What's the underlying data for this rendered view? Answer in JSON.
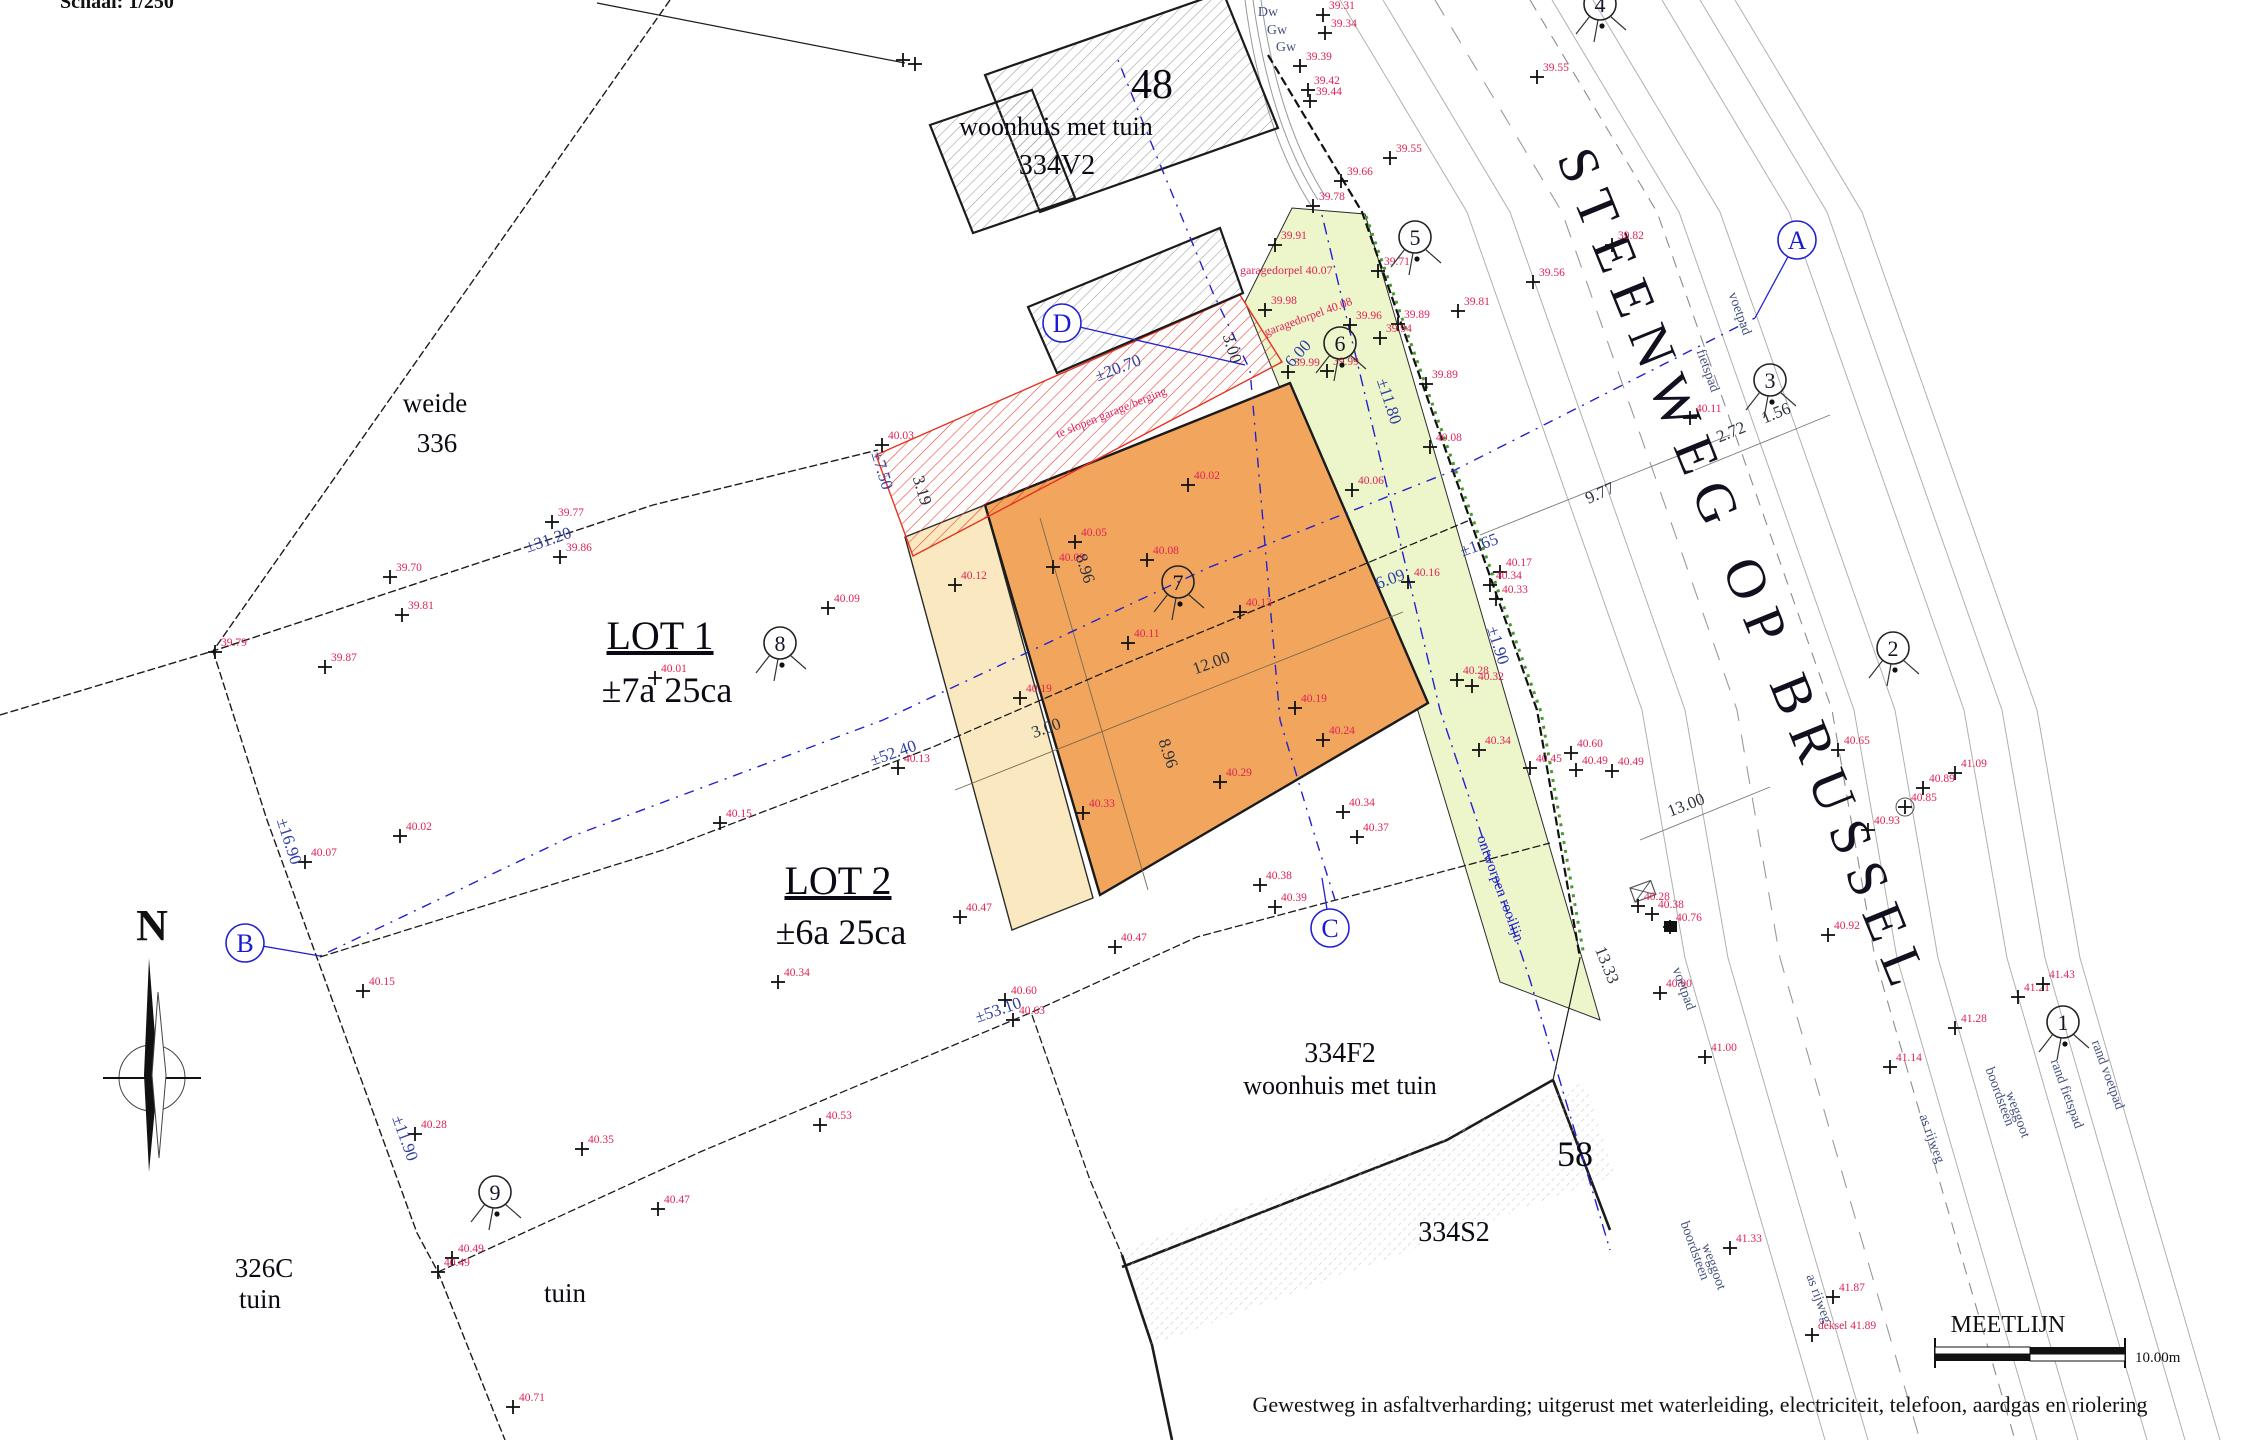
{
  "meta": {
    "scale_note": "Schaal: 1/250",
    "road_name": "STEENWEG OP BRUSSEL",
    "rooilijn_label": "ontworpen rooilijn",
    "meetlijn_title": "MEETLIJN",
    "meetlijn_scale": "10.00m",
    "bottom_note": "Gewestweg in asfaltverharding; uitgerust met waterleiding, electriciteit, telefoon, aardgas en riolering"
  },
  "colors": {
    "lot_orange": "#F2A55C",
    "lot_cream": "#FAE9C0",
    "verge_green": "#EDF5CB",
    "demolish_red": "#E63322",
    "meetlijn_blue": "#2222D0",
    "elevation_red": "#E02355",
    "dimension_blue": "#2F3F9F",
    "hedge_green": "#4A9A30"
  },
  "parcel_labels": [
    {
      "t": "weide",
      "x": 435,
      "y": 412,
      "fs": 27
    },
    {
      "t": "336",
      "x": 437,
      "y": 452,
      "fs": 27
    },
    {
      "t": "LOT 1",
      "x": 660,
      "y": 649,
      "fs": 40,
      "u": 1
    },
    {
      "t": "±7a 25ca",
      "x": 667,
      "y": 702,
      "fs": 36
    },
    {
      "t": "LOT 2",
      "x": 838,
      "y": 894,
      "fs": 40,
      "u": 1
    },
    {
      "t": "±6a 25ca",
      "x": 841,
      "y": 944,
      "fs": 36
    },
    {
      "t": "326C",
      "x": 264,
      "y": 1277,
      "fs": 27
    },
    {
      "t": "tuin",
      "x": 260,
      "y": 1308,
      "fs": 27
    },
    {
      "t": "tuin",
      "x": 565,
      "y": 1302,
      "fs": 27
    },
    {
      "t": "48",
      "x": 1152,
      "y": 98,
      "fs": 42
    },
    {
      "t": "woonhuis met tuin",
      "x": 1056,
      "y": 135,
      "fs": 26
    },
    {
      "t": "334V2",
      "x": 1057,
      "y": 174,
      "fs": 28
    },
    {
      "t": "334F2",
      "x": 1340,
      "y": 1062,
      "fs": 28
    },
    {
      "t": "woonhuis met tuin",
      "x": 1340,
      "y": 1094,
      "fs": 26
    },
    {
      "t": "334S2",
      "x": 1454,
      "y": 1241,
      "fs": 28
    },
    {
      "t": "58",
      "x": 1575,
      "y": 1166,
      "fs": 36
    }
  ],
  "red_notes": [
    {
      "t": "garagedorpel 40.07",
      "x": 1240,
      "y": 274,
      "r": 0
    },
    {
      "t": "garagedorpel 40.08",
      "x": 1266,
      "y": 336,
      "r": -20
    },
    {
      "t": "te slopen garage/berging",
      "x": 1058,
      "y": 438,
      "r": -22
    }
  ],
  "dimensions": [
    {
      "t": "±20.70",
      "x": 1120,
      "y": 373,
      "r": -21
    },
    {
      "t": "±7.50",
      "x": 877,
      "y": 472,
      "r": 73
    },
    {
      "t": "3.19",
      "x": 917,
      "y": 492,
      "r": 73,
      "dark": 1
    },
    {
      "t": "3.00",
      "x": 1227,
      "y": 350,
      "r": 73,
      "dark": 1
    },
    {
      "t": "6.00",
      "x": 1302,
      "y": 357,
      "r": -48
    },
    {
      "t": "±31.20",
      "x": 550,
      "y": 545,
      "r": -19
    },
    {
      "t": "±52.40",
      "x": 895,
      "y": 758,
      "r": -19
    },
    {
      "t": "±53.10",
      "x": 1000,
      "y": 1015,
      "r": -19
    },
    {
      "t": "±16.90",
      "x": 284,
      "y": 843,
      "r": 72
    },
    {
      "t": "±11.90",
      "x": 400,
      "y": 1140,
      "r": 70
    },
    {
      "t": "±11.80",
      "x": 1384,
      "y": 403,
      "r": 72
    },
    {
      "t": "±1.65",
      "x": 1481,
      "y": 550,
      "r": -20
    },
    {
      "t": "6.09",
      "x": 1392,
      "y": 584,
      "r": -20
    },
    {
      "t": "±1.90",
      "x": 1493,
      "y": 647,
      "r": 72
    },
    {
      "t": "9.77",
      "x": 1602,
      "y": 498,
      "r": -24,
      "dark": 1
    },
    {
      "t": "2.72",
      "x": 1733,
      "y": 437,
      "r": -22,
      "dark": 1
    },
    {
      "t": "1.56",
      "x": 1778,
      "y": 418,
      "r": -22,
      "dark": 1
    },
    {
      "t": "13.00",
      "x": 1688,
      "y": 810,
      "r": -21,
      "dark": 1
    },
    {
      "t": "13.33",
      "x": 1602,
      "y": 967,
      "r": 68,
      "dark": 1
    },
    {
      "t": "8.96",
      "x": 1080,
      "y": 570,
      "r": 72,
      "dark": 1
    },
    {
      "t": "8.96",
      "x": 1163,
      "y": 755,
      "r": 72,
      "dark": 1
    },
    {
      "t": "12.00",
      "x": 1213,
      "y": 668,
      "r": -20,
      "dark": 1
    },
    {
      "t": "3.00",
      "x": 1048,
      "y": 733,
      "r": -20,
      "dark": 1
    }
  ],
  "survey_points": [
    {
      "v": "39.31",
      "x": 1323,
      "y": 15
    },
    {
      "v": "39.34",
      "x": 1325,
      "y": 33
    },
    {
      "v": "39.39",
      "x": 1300,
      "y": 66
    },
    {
      "v": "39.42",
      "x": 1308,
      "y": 90
    },
    {
      "v": "39.44",
      "x": 1310,
      "y": 101
    },
    {
      "v": "39.55",
      "x": 1537,
      "y": 77
    },
    {
      "v": "39.55",
      "x": 1390,
      "y": 158
    },
    {
      "v": "39.66",
      "x": 1341,
      "y": 181
    },
    {
      "v": "39.78",
      "x": 1313,
      "y": 206
    },
    {
      "v": "39.91",
      "x": 1275,
      "y": 245
    },
    {
      "v": "39.71",
      "x": 1378,
      "y": 271
    },
    {
      "v": "39.82",
      "x": 1612,
      "y": 245
    },
    {
      "v": "39.56",
      "x": 1533,
      "y": 282
    },
    {
      "v": "39.81",
      "x": 1458,
      "y": 311
    },
    {
      "v": "39.96",
      "x": 1350,
      "y": 325
    },
    {
      "v": "39.89",
      "x": 1398,
      "y": 324
    },
    {
      "v": "39.94",
      "x": 1380,
      "y": 338
    },
    {
      "v": "39.89",
      "x": 1426,
      "y": 384
    },
    {
      "v": "39.98",
      "x": 1265,
      "y": 310
    },
    {
      "v": "39.99",
      "x": 1288,
      "y": 372
    },
    {
      "v": "39.99",
      "x": 1327,
      "y": 371
    },
    {
      "v": "40.03",
      "x": 882,
      "y": 445
    },
    {
      "v": "40.02",
      "x": 1188,
      "y": 485
    },
    {
      "v": "40.06",
      "x": 1352,
      "y": 490
    },
    {
      "v": "40.05",
      "x": 1075,
      "y": 542
    },
    {
      "v": "40.08",
      "x": 1147,
      "y": 560
    },
    {
      "v": "40.09",
      "x": 1053,
      "y": 567
    },
    {
      "v": "40.12",
      "x": 955,
      "y": 585
    },
    {
      "v": "40.11",
      "x": 1128,
      "y": 643
    },
    {
      "v": "40.13",
      "x": 1240,
      "y": 612
    },
    {
      "v": "40.08",
      "x": 1430,
      "y": 447
    },
    {
      "v": "40.11",
      "x": 1690,
      "y": 418
    },
    {
      "v": "40.19",
      "x": 1020,
      "y": 698
    },
    {
      "v": "40.19",
      "x": 1295,
      "y": 708
    },
    {
      "v": "40.24",
      "x": 1323,
      "y": 740
    },
    {
      "v": "40.29",
      "x": 1220,
      "y": 782
    },
    {
      "v": "40.33",
      "x": 1083,
      "y": 813
    },
    {
      "v": "40.34",
      "x": 1343,
      "y": 812
    },
    {
      "v": "40.16",
      "x": 1408,
      "y": 582
    },
    {
      "v": "40.17",
      "x": 1500,
      "y": 572
    },
    {
      "v": "40.34",
      "x": 1490,
      "y": 585
    },
    {
      "v": "40.33",
      "x": 1496,
      "y": 599
    },
    {
      "v": "40.28",
      "x": 1457,
      "y": 680
    },
    {
      "v": "40.32",
      "x": 1472,
      "y": 686
    },
    {
      "v": "40.34",
      "x": 1479,
      "y": 750
    },
    {
      "v": "40.60",
      "x": 1571,
      "y": 753
    },
    {
      "v": "40.45",
      "x": 1530,
      "y": 768
    },
    {
      "v": "40.49",
      "x": 1576,
      "y": 770
    },
    {
      "v": "40.49",
      "x": 1612,
      "y": 771
    },
    {
      "v": "40.09",
      "x": 828,
      "y": 608
    },
    {
      "v": "40.01",
      "x": 655,
      "y": 678
    },
    {
      "v": "40.15",
      "x": 720,
      "y": 823
    },
    {
      "v": "40.13",
      "x": 898,
      "y": 768
    },
    {
      "v": "39.77",
      "x": 552,
      "y": 522
    },
    {
      "v": "39.86",
      "x": 560,
      "y": 557
    },
    {
      "v": "39.70",
      "x": 390,
      "y": 577
    },
    {
      "v": "39.81",
      "x": 402,
      "y": 615
    },
    {
      "v": "39.79",
      "x": 215,
      "y": 652
    },
    {
      "v": "39.87",
      "x": 325,
      "y": 667
    },
    {
      "v": "40.02",
      "x": 400,
      "y": 836
    },
    {
      "v": "40.07",
      "x": 305,
      "y": 862
    },
    {
      "v": "40.15",
      "x": 363,
      "y": 991
    },
    {
      "v": "40.28",
      "x": 415,
      "y": 1134
    },
    {
      "v": "40.35",
      "x": 582,
      "y": 1149
    },
    {
      "v": "40.47",
      "x": 658,
      "y": 1209
    },
    {
      "v": "40.49",
      "x": 452,
      "y": 1258
    },
    {
      "v": "40.49",
      "x": 438,
      "y": 1272
    },
    {
      "v": "40.71",
      "x": 513,
      "y": 1407
    },
    {
      "v": "40.34",
      "x": 778,
      "y": 982
    },
    {
      "v": "40.47",
      "x": 960,
      "y": 917
    },
    {
      "v": "40.47",
      "x": 1115,
      "y": 947
    },
    {
      "v": "40.60",
      "x": 1005,
      "y": 1000
    },
    {
      "v": "40.63",
      "x": 1013,
      "y": 1020
    },
    {
      "v": "40.53",
      "x": 820,
      "y": 1125
    },
    {
      "v": "40.37",
      "x": 1357,
      "y": 837
    },
    {
      "v": "40.38",
      "x": 1260,
      "y": 885
    },
    {
      "v": "40.39",
      "x": 1275,
      "y": 907
    },
    {
      "v": "40.28",
      "x": 1638,
      "y": 906
    },
    {
      "v": "40.38",
      "x": 1652,
      "y": 914
    },
    {
      "v": "40.76",
      "x": 1670,
      "y": 927,
      "sym": "sq"
    },
    {
      "v": "40.90",
      "x": 1660,
      "y": 993
    },
    {
      "v": "41.00",
      "x": 1705,
      "y": 1057
    },
    {
      "v": "41.09",
      "x": 1955,
      "y": 773
    },
    {
      "v": "40.65",
      "x": 1838,
      "y": 750
    },
    {
      "v": "40.89",
      "x": 1923,
      "y": 788
    },
    {
      "v": "40.85",
      "x": 1905,
      "y": 807,
      "sym": "ci"
    },
    {
      "v": "40.93",
      "x": 1868,
      "y": 830
    },
    {
      "v": "40.92",
      "x": 1828,
      "y": 935
    },
    {
      "v": "41.14",
      "x": 1890,
      "y": 1067
    },
    {
      "v": "41.28",
      "x": 1955,
      "y": 1028
    },
    {
      "v": "41.21",
      "x": 2018,
      "y": 997
    },
    {
      "v": "41.43",
      "x": 2043,
      "y": 984
    },
    {
      "v": "41.33",
      "x": 1730,
      "y": 1248
    },
    {
      "v": "41.87",
      "x": 1833,
      "y": 1297
    },
    {
      "v": "deksel 41.89",
      "x": 1812,
      "y": 1335
    },
    {
      "v": "",
      "x": 903,
      "y": 60
    },
    {
      "v": "",
      "x": 915,
      "y": 64
    }
  ],
  "stations": [
    {
      "n": "1",
      "x": 2063,
      "y": 1022
    },
    {
      "n": "2",
      "x": 1893,
      "y": 648
    },
    {
      "n": "3",
      "x": 1770,
      "y": 380
    },
    {
      "n": "4",
      "x": 1600,
      "y": 4
    },
    {
      "n": "5",
      "x": 1415,
      "y": 237
    },
    {
      "n": "6",
      "x": 1340,
      "y": 343
    },
    {
      "n": "7",
      "x": 1178,
      "y": 582
    },
    {
      "n": "8",
      "x": 780,
      "y": 643
    },
    {
      "n": "9",
      "x": 495,
      "y": 1192
    }
  ],
  "ref_letters": [
    {
      "ch": "A",
      "x": 1797,
      "y": 240,
      "lx": 1755,
      "ly": 318
    },
    {
      "ch": "B",
      "x": 245,
      "y": 943,
      "lx": 320,
      "ly": 956
    },
    {
      "ch": "C",
      "x": 1330,
      "y": 928,
      "lx": 1322,
      "ly": 878
    },
    {
      "ch": "D",
      "x": 1062,
      "y": 323,
      "lx": 1245,
      "ly": 365
    }
  ],
  "road_labels": [
    {
      "t": "voetpad",
      "x": 1736,
      "y": 315,
      "r": 70
    },
    {
      "t": "fietspad",
      "x": 1704,
      "y": 372,
      "r": 70
    },
    {
      "t": "voetpad",
      "x": 1680,
      "y": 990,
      "r": 70
    },
    {
      "t": "as rijweg",
      "x": 1928,
      "y": 1140,
      "r": 70
    },
    {
      "t": "as rijweg",
      "x": 1815,
      "y": 1300,
      "r": 70
    },
    {
      "t": "boordsteen",
      "x": 1996,
      "y": 1098,
      "r": 70
    },
    {
      "t": "weggoot",
      "x": 2014,
      "y": 1116,
      "r": 70
    },
    {
      "t": "boordsteen",
      "x": 1691,
      "y": 1252,
      "r": 70
    },
    {
      "t": "weggoot",
      "x": 1710,
      "y": 1268,
      "r": 70
    },
    {
      "t": "rand fietspad",
      "x": 2063,
      "y": 1095,
      "r": 70
    },
    {
      "t": "rand voetpad",
      "x": 2104,
      "y": 1076,
      "r": 70
    },
    {
      "t": "Dw",
      "x": 1268,
      "y": 16,
      "r": 0
    },
    {
      "t": "Gw",
      "x": 1277,
      "y": 34,
      "r": 0
    },
    {
      "t": "Gw",
      "x": 1286,
      "y": 51,
      "r": 0
    }
  ]
}
